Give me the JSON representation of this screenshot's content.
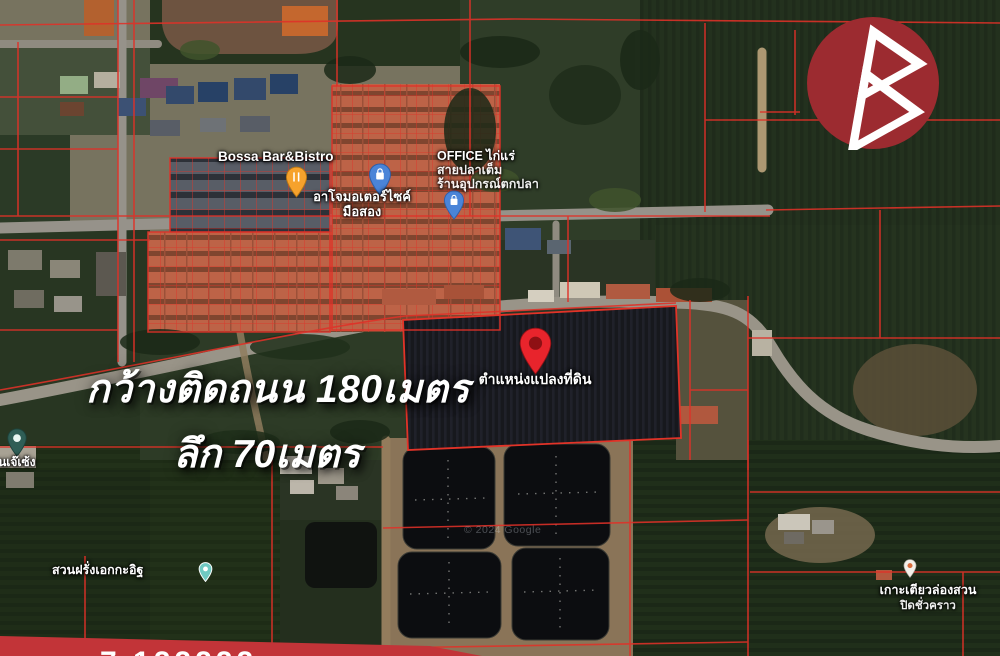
{
  "overlay_text": {
    "line1": "กว้างติดถนน 180เมตร",
    "line2": "ลึก 70เมตร"
  },
  "plot_marker": {
    "label": "ตำแหน่งแปลงที่ดิน",
    "pin_color": "#e8242c"
  },
  "poi_labels": {
    "bossa": {
      "name": "Bossa Bar&Bistro",
      "pin": "restaurant-pin",
      "pin_color": "#f6a22c"
    },
    "ajo": {
      "line1": "อาโจมอเตอร์ไซค์",
      "line2": "มือสอง",
      "pin": "shopping-pin",
      "pin_color": "#4a84d8"
    },
    "office": {
      "line1": "OFFICE ไก่แร่",
      "line2": "สายปลาเต็ม",
      "line3": "ร้านอุปกรณ์ตกปลา",
      "pin": "shopping-pin",
      "pin_color": "#4a84d8"
    },
    "jeseng": {
      "name": "สวนเจ๊เซ้ง"
    },
    "guava_farm": {
      "name": "สวนฝรั่งเอกกะอิฐ"
    },
    "kohtoey": {
      "line1": "เกาะเตียวล่องสวน",
      "line2": "ปิดชั่วคราว"
    }
  },
  "map_attribution": "© 2024 Google",
  "bottom_banner": {
    "partial_text": "7 122222",
    "color": "#c23438"
  },
  "branding": {
    "logo_shape": "double-triangle-B",
    "logo_bg": "#9c2b30"
  },
  "map_colors": {
    "parcel_line": "#e03128",
    "road": "#96928a",
    "plot_fill": "#17181d",
    "pond_fill": "#0c0d10"
  }
}
